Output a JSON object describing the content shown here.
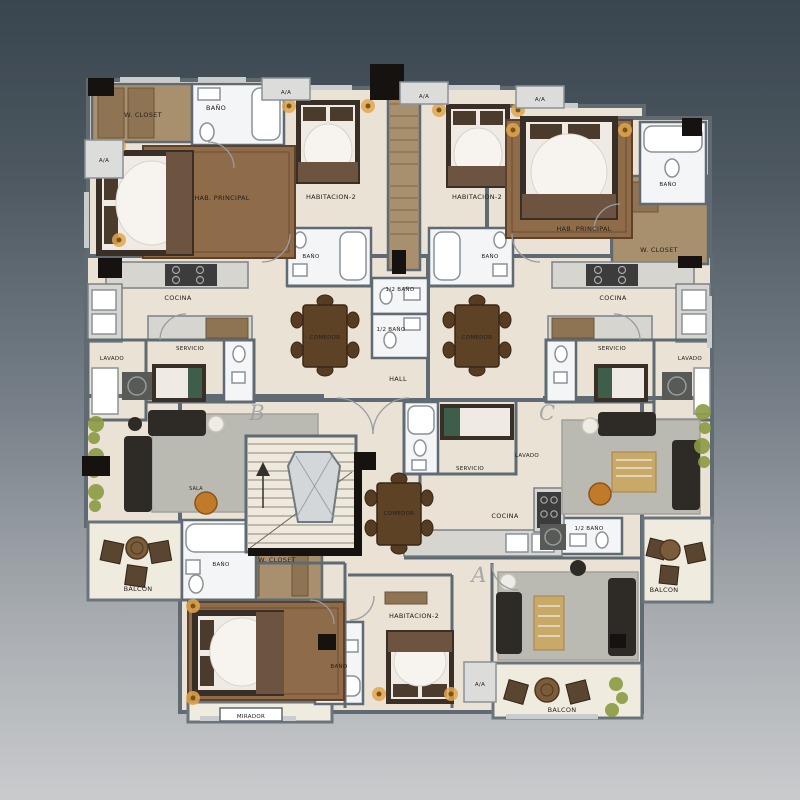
{
  "image_type": "architectural-floor-plan",
  "background": {
    "gradient_top": "#39454f",
    "gradient_mid": "#79828a",
    "gradient_bottom": "#c9cbcd"
  },
  "palette": {
    "floor_beige": "#e9e2d5",
    "wall_gray": "#5f6a72",
    "bathroom_white": "#f4f5f6",
    "balcony_cream": "#f0ebdf",
    "closet_wood": "#a8906e",
    "counter_granite": "#d7d5d0",
    "rug_brown": "#8f6c49",
    "rug_gray": "#bab9b2",
    "furniture_dark": "#2e2a26",
    "accent_gold": "#c8a968",
    "plant_green": "#8a9a43",
    "lamp_glow": "#e0a64f",
    "column_black": "#15120f"
  },
  "labels": {
    "w_closet": "W. CLOSET",
    "bano": "BAÑO",
    "half_bano": "1/2 BAÑO",
    "aa": "A/A",
    "hab_principal": "HAB. PRINCIPAL",
    "habitacion_2": "HABITACION-2",
    "cocina": "COCINA",
    "servicio": "SERVICIO",
    "lavado": "LAVADO",
    "comedor": "COMEDOR",
    "hall": "HALL",
    "sala": "SALA",
    "balcon": "BALCON",
    "mirador": "MIRADOR"
  },
  "units": {
    "a": "A",
    "b": "B",
    "c": "C"
  }
}
